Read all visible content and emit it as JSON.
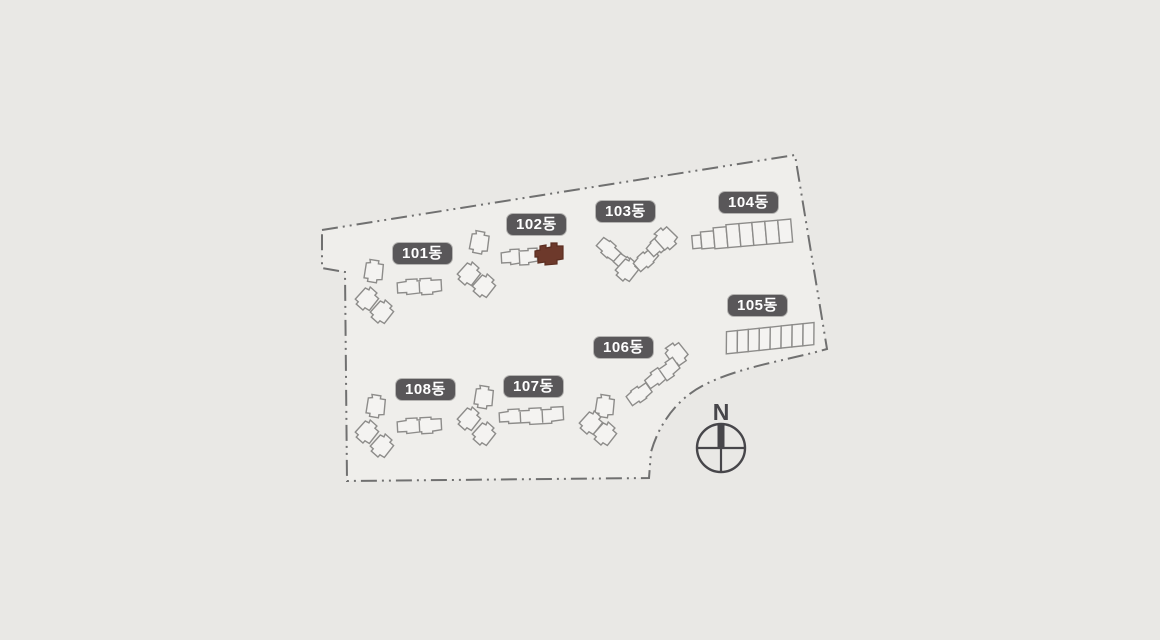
{
  "site": {
    "compass_label": "N",
    "buildings": [
      {
        "id": "101",
        "label": "101동",
        "highlighted": false
      },
      {
        "id": "102",
        "label": "102동",
        "highlighted": true
      },
      {
        "id": "103",
        "label": "103동",
        "highlighted": false
      },
      {
        "id": "104",
        "label": "104동",
        "highlighted": false
      },
      {
        "id": "105",
        "label": "105동",
        "highlighted": false
      },
      {
        "id": "106",
        "label": "106동",
        "highlighted": false
      },
      {
        "id": "107",
        "label": "107동",
        "highlighted": false
      },
      {
        "id": "108",
        "label": "108동",
        "highlighted": false
      }
    ],
    "colors": {
      "highlight": "#6d392b",
      "badge_bg": "#595759",
      "badge_text": "#ffffff",
      "boundary_line": "#707070",
      "building_outline": "#8d8c8a",
      "background": "#e9e8e5"
    }
  }
}
